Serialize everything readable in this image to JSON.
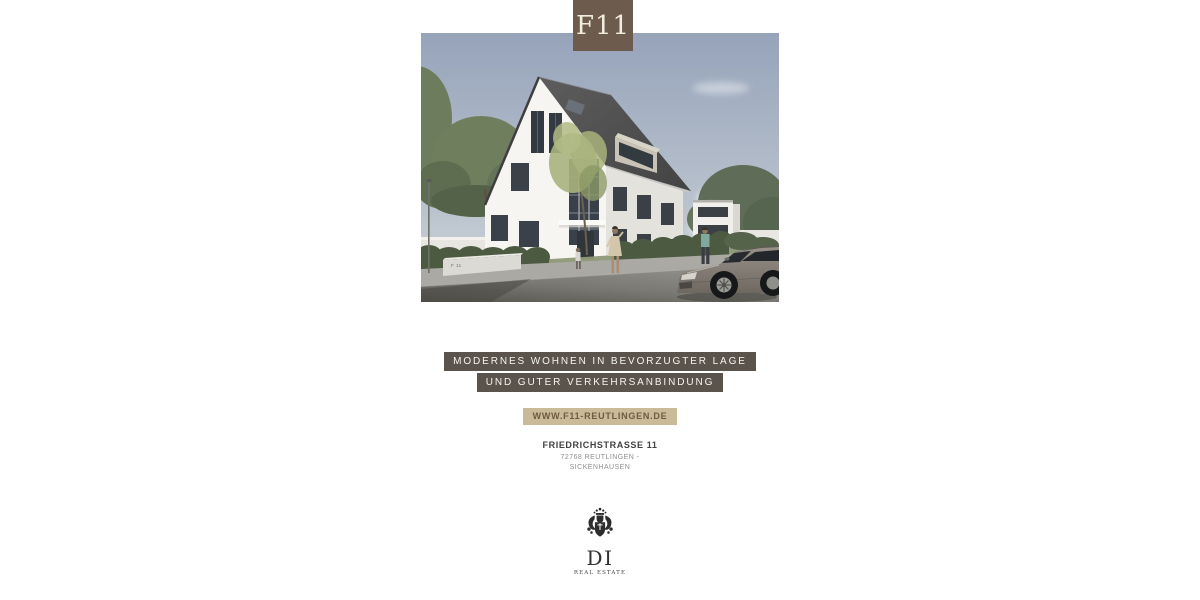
{
  "badge": {
    "label": "F11",
    "bg": "#6d5c4d",
    "fg": "#f2ebdf"
  },
  "hero": {
    "wall_sign": "F 11",
    "sky_color": "#9aa6bb",
    "roof_color": "#4f4f4f",
    "facade_color": "#f6f5f2",
    "greenery_color": "#62704f",
    "car_color": "#8a847c"
  },
  "headline": {
    "line1": "MODERNES WOHNEN IN BEVORZUGTER LAGE",
    "line2": "UND GUTER VERKEHRSANBINDUNG",
    "bg": "#5b544c",
    "fg": "#f6f4f0"
  },
  "website": {
    "label": "WWW.F11-REUTLINGEN.DE",
    "bg": "#c9ba98",
    "fg": "#6e5b40"
  },
  "address": {
    "street": "FRIEDRICHSTRASSE 11",
    "city": "72768 REUTLINGEN -",
    "district": "SICKENHAUSEN"
  },
  "logo": {
    "monogram": "DI",
    "subtitle": "REAL ESTATE",
    "color": "#2b2b2b"
  }
}
